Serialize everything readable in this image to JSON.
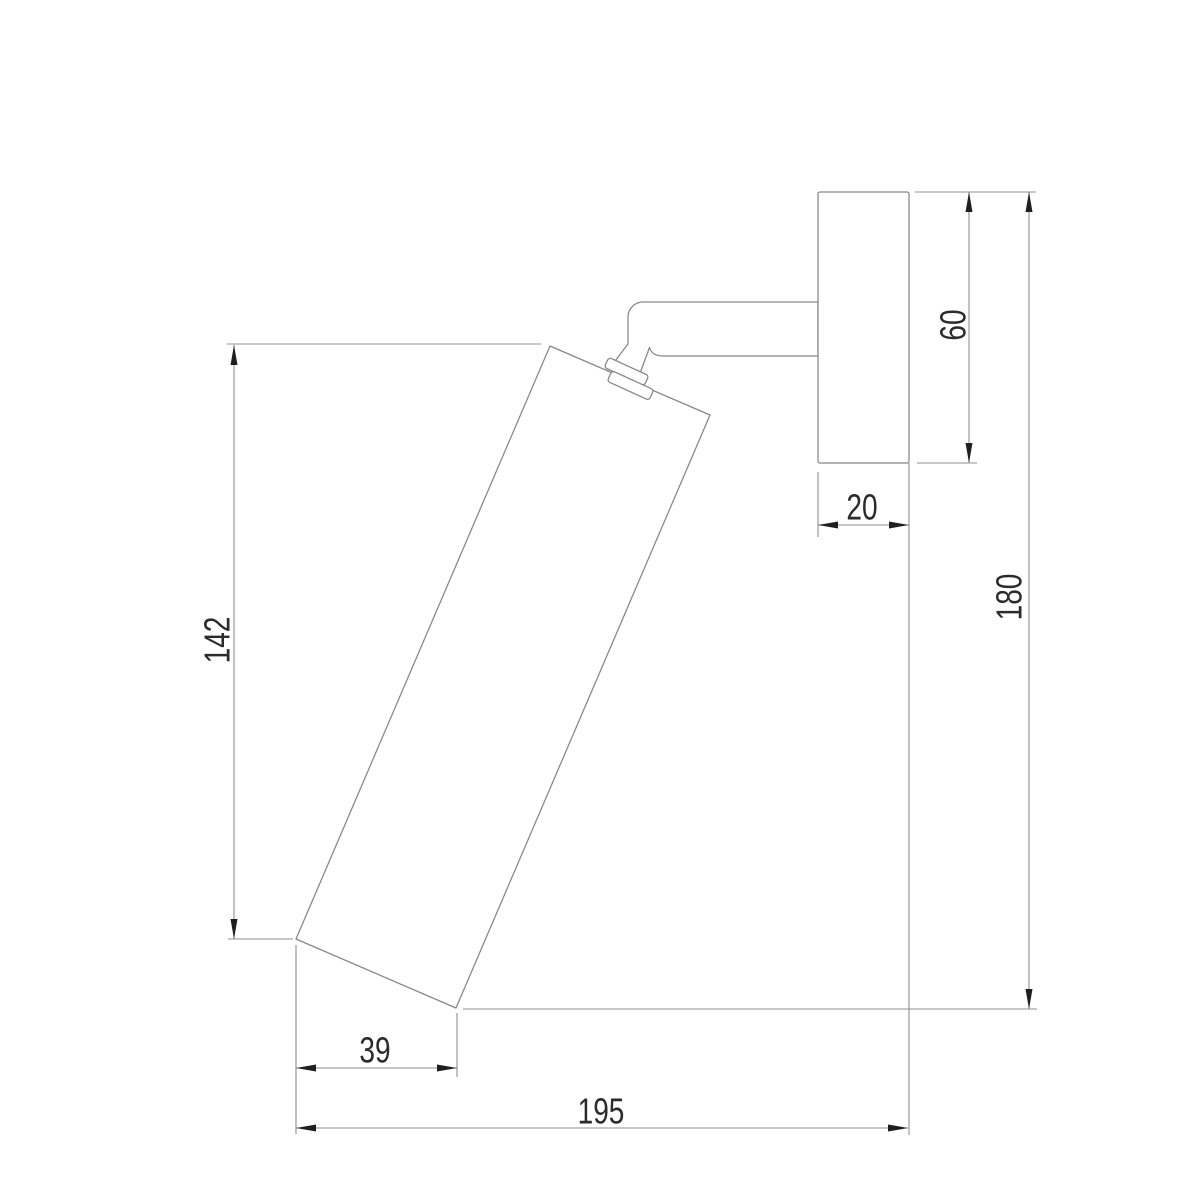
{
  "drawing": {
    "type": "technical-dimension-drawing",
    "subject": "wall-mounted adjustable spotlight, side elevation"
  },
  "dimensions": {
    "body_length": "142",
    "overall_height": "180",
    "plate_height": "60",
    "plate_depth": "20",
    "body_bottom_offset": "39",
    "overall_depth": "195"
  },
  "colors": {
    "background": "#ffffff",
    "line": "#868686",
    "dimension_line": "#8f8f8f",
    "arrow": "#1f1f1f",
    "text": "#2b2b2b"
  }
}
